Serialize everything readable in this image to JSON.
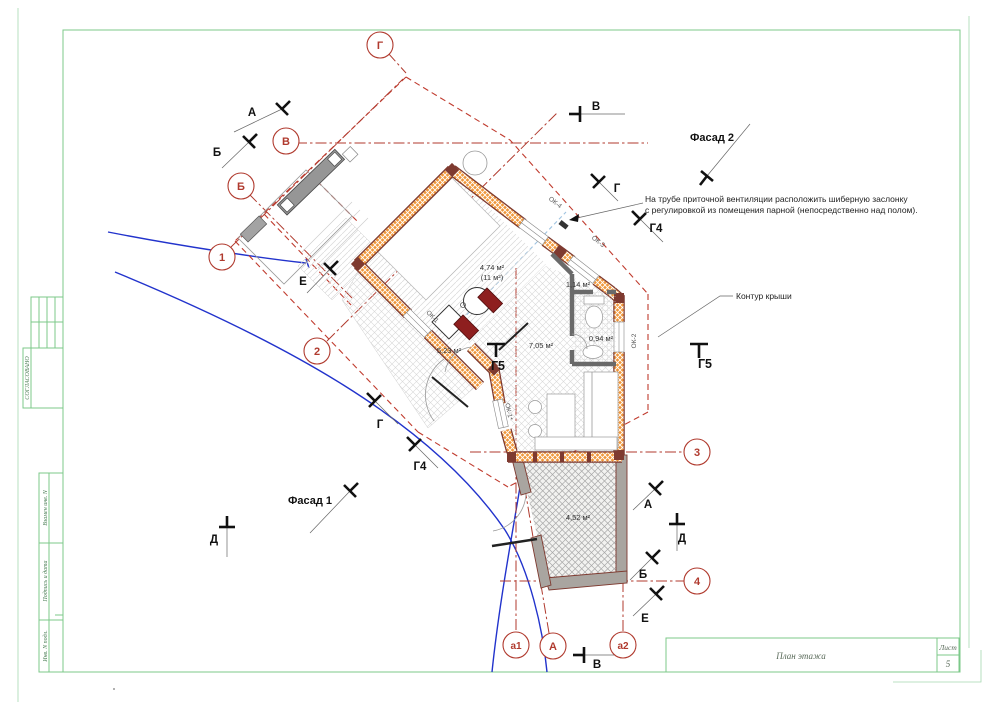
{
  "axes": {
    "g": "Г",
    "v": "В",
    "b": "Б",
    "n1": "1",
    "n2": "2",
    "n3": "3",
    "n4": "4",
    "a1": "а1",
    "a_cap": "А",
    "a2": "а2"
  },
  "sections": {
    "a": "А",
    "b": "Б",
    "v": "В",
    "g": "Г",
    "d": "Д",
    "e": "Е",
    "g4": "Г4",
    "g5": "Г5"
  },
  "facades": {
    "f1": "Фасад 1",
    "f2": "Фасад 2"
  },
  "annotation": {
    "line1": "На трубе приточной вентиляции расположить шиберную заслонку",
    "line2": "с регулировкой из помещения парной (непосредственно над полом)."
  },
  "roof_label": "Контур крыши",
  "rooms": {
    "parnaya": "4,74 м²",
    "parnaya_note": "(11 м²)",
    "hall": "1,14 м²",
    "rest": "7,05 м²",
    "entry": "5,23 м²",
    "bath": "0,94 м²",
    "terrace": "4,52 м²"
  },
  "windows": {
    "ok1": "ОК-1",
    "ok1s": "ОК-1*",
    "ok2": "ОК-2",
    "ok3": "ОК-3",
    "ok4": "ОК-4"
  },
  "stamp": {
    "soglasovano": "СОГЛАСОВАНО",
    "vzamen": "Взамен инв. N",
    "podpis": "Подпись и дата",
    "inv": "Инв. N подл."
  },
  "titleblock": {
    "title": "План этажа",
    "sheet_label": "Лист",
    "sheet_number": "5"
  },
  "colors": {
    "frame_green": "#7cc98a",
    "axis_red": "#b03a2e",
    "wall_orange": "#f0973a",
    "wall_border": "#7e3a30",
    "site_blue": "#2233cc"
  }
}
